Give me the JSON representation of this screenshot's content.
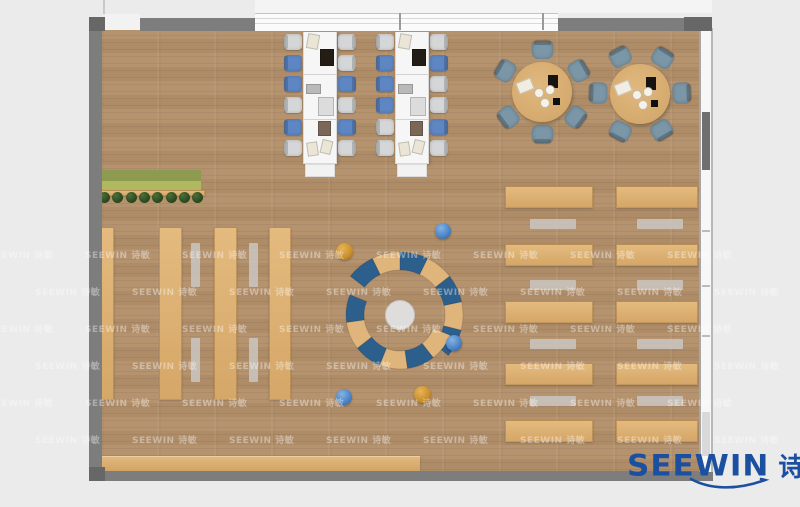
{
  "image": {
    "type": "floor-plan rendering",
    "description": "Top-down rendering of a library reading room: two long study tables with chairs, two round discussion tables, bookshelf rows, a circular modular lounge sofa, planter and service counter"
  },
  "watermark": {
    "text": "SEEWIN 诗敏"
  },
  "logo": {
    "en": "SEEWIN",
    "cn": "诗敏"
  },
  "palette": {
    "background": "#ebebeb",
    "floor": "#b3906a",
    "wall": "#7d7d7d",
    "wall_dark": "#676767",
    "window_white": "#fbfbfb",
    "table_white": "#f6f6f6",
    "chair_blue": "#5d86c3",
    "chair_gray": "#d4d6d7",
    "round_chair": "#7b97a7",
    "round_table": "#d5aa6e",
    "lounge_blue": "#2c5f8c",
    "lounge_tan": "#dfb57c",
    "lounge_center": "#dedddb",
    "planter_green_dark": "#8e9a50",
    "planter_green_light": "#b0b960",
    "plant": "#27441d",
    "stool_blue": "#4a82c4",
    "stool_orange": "#c98e2c",
    "gray_strip": "#c9c5c0",
    "logo_color": "#1b4fa0"
  },
  "furniture": {
    "long_tables": {
      "count": 2,
      "chairs_per_table": 12,
      "chair_colors": {
        "t1_left": [
          "g",
          "b",
          "b",
          "g",
          "b",
          "g"
        ],
        "t1_right": [
          "g",
          "g",
          "b",
          "g",
          "b",
          "g"
        ],
        "t2_left": [
          "g",
          "b",
          "b",
          "b",
          "g",
          "g"
        ],
        "t2_right": [
          "g",
          "b",
          "g",
          "g",
          "b",
          "g"
        ]
      }
    },
    "round_tables": {
      "count": 2,
      "chairs_each": 6
    },
    "bookshelves": {
      "columns": 4
    },
    "right_desk_rows": {
      "columns": 2,
      "wood_rows": 5,
      "bench_rows": 4
    },
    "lounge": {
      "type": "circular modular sofa",
      "arc_rings": 2,
      "segments": 13
    },
    "planter": {
      "plants": 8
    },
    "stools": {
      "blue": 3,
      "orange": 2
    }
  }
}
